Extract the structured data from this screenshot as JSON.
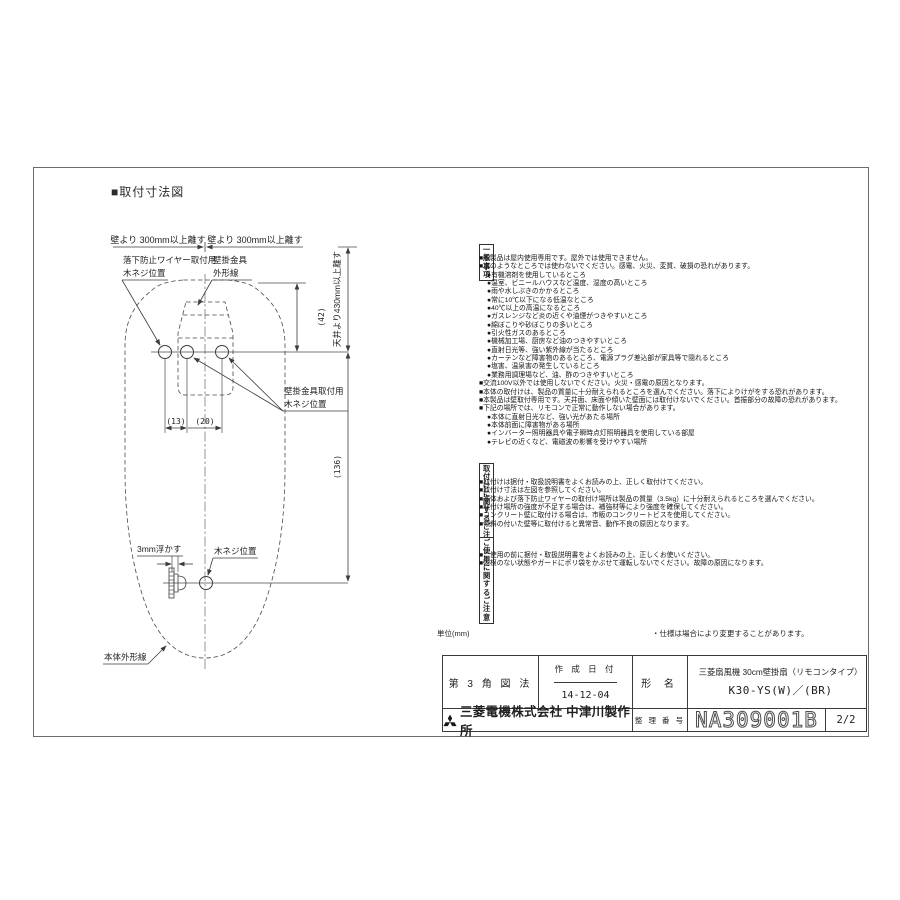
{
  "page": {
    "title": "■取付寸法図",
    "unit_note": "単位(mm)",
    "spec_note": "・仕様は場合により変更することがあります。"
  },
  "drawing": {
    "clearance_left": "壁より 300mm以上離す",
    "clearance_right": "壁より 300mm以上離す",
    "clearance_ceiling": "天井より430mm以上離す",
    "label_wire_screw": [
      "落下防止ワイヤー取付用",
      "木ネジ位置"
    ],
    "label_bracket_outline": [
      "壁掛金具",
      "外形線"
    ],
    "label_bracket_screw": [
      "壁掛金具取付用",
      "木ネジ位置"
    ],
    "label_float": "3mm浮かす",
    "label_screw_pos": "木ネジ位置",
    "label_body_outline": "本体外形線",
    "dim_top_to_screw": "(42)",
    "dim_pitch_left": "(13)",
    "dim_pitch_right": "(20)",
    "dim_upper_to_lower": "(136)"
  },
  "notes": {
    "general": {
      "heading": "一般事項",
      "lines": [
        "■本製品は屋内使用専用です。屋外では使用できません。",
        "■次のようなところでは使わないでください。感電、火災、変質、破損の恐れがあります。",
        "●有機溶剤を使用しているところ",
        "●温室、ビニールハウスなど温度、湿度の高いところ",
        "●雨や水しぶきのかかるところ",
        "●常に10℃以下になる低温なところ",
        "●40℃以上の高温になるところ",
        "●ガスレンジなど炎の近くや油煙がつきやすいところ",
        "●綿ぼこりや砂ぼこりの多いところ",
        "●引火性ガスのあるところ",
        "●機械加工場、厨房など油のつきやすいところ",
        "●直射日光等、強い紫外線が当たるところ",
        "●カーテンなど障害物のあるところ、電源プラグ差込部が家具等で隠れるところ",
        "●塩害、温泉害の発生しているところ",
        "●業務用調理場など、油、酢のつきやすいところ",
        "■交流100V以外では使用しないでください。火災・感電の原因となります。",
        "■本体の取付けは、製品の質量に十分耐えられるところを選んでください。落下によりけがをする恐れがあります。",
        "■本製品は壁取付専用です。天井面、床面や傾いた壁面には取付けないでください。首振部分の故障の恐れがあります。",
        "■下記の場所では、リモコンで正常に動作しない場合があります。",
        "●本体に直射日光など、強い光があたる場所",
        "●本体前面に障害物がある場所",
        "●インバーター照明器具や電子瞬時点灯照明器具を使用している部屋",
        "●テレビの近くなど、電磁波の影響を受けやすい場所"
      ]
    },
    "install": {
      "heading": "取付けに関するご注意",
      "lines": [
        "■取付けは据付・取扱説明書をよくお読みの上、正しく取付けてください。",
        "■取付け寸法は左図を参照してください。",
        "■本体および落下防止ワイヤーの取付け場所は製品の質量（3.5kg）に十分耐えられるところを選んでください。",
        "■取付け場所の強度が不足する場合は、補強材等により強度を確保してください。",
        "■コンクリート壁に取付ける場合は、市販のコンクリートビスを使用してください。",
        "■傾斜の付いた壁等に取付けると異常音、動作不良の原因となります。"
      ]
    },
    "usage": {
      "heading": "ご使用に関するご注意",
      "lines": [
        "■ご使用の前に据付・取扱説明書をよくお読みの上、正しくお使いください。",
        "■羽根のない状態やガードにポリ袋をかぶせて運転しないでください。故障の原因になります。"
      ]
    }
  },
  "title_block": {
    "projection": "第 3 角 図 法",
    "date_label": "作 成 日 付",
    "date_value": "14-12-04",
    "model_label": "形 名",
    "product_line1": "三菱扇風機 30cm壁掛扇（リモコンタイプ）",
    "product_line2": "K30-YS(W)／(BR)",
    "company": "三菱電機株式会社 中津川製作所",
    "logo_icon": "mitsubishi-three-diamond-logo",
    "ref_label": "整 理 番 号",
    "ref_number": "NA309001B",
    "page_number": "2/2"
  }
}
